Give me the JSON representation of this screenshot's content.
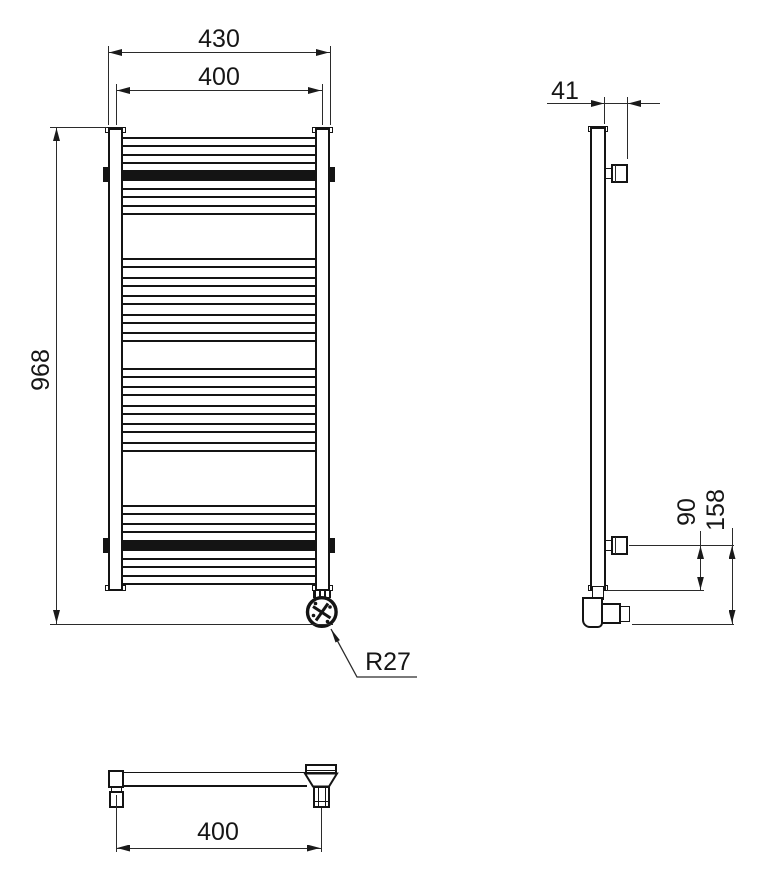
{
  "drawing_type": "towel-radiator technical drawing, three orthographic views",
  "dimensions": {
    "front_overall_width": "430",
    "front_center_width": "400",
    "front_height": "968",
    "front_element_radius": "R27",
    "side_depth": "41",
    "side_bracket_to_bottom": "90",
    "side_bracket_to_element": "158",
    "bottom_center_width": "400"
  },
  "colors": {
    "line": "#141414",
    "dimension_line": "#2b2b2b",
    "background": "#ffffff"
  }
}
